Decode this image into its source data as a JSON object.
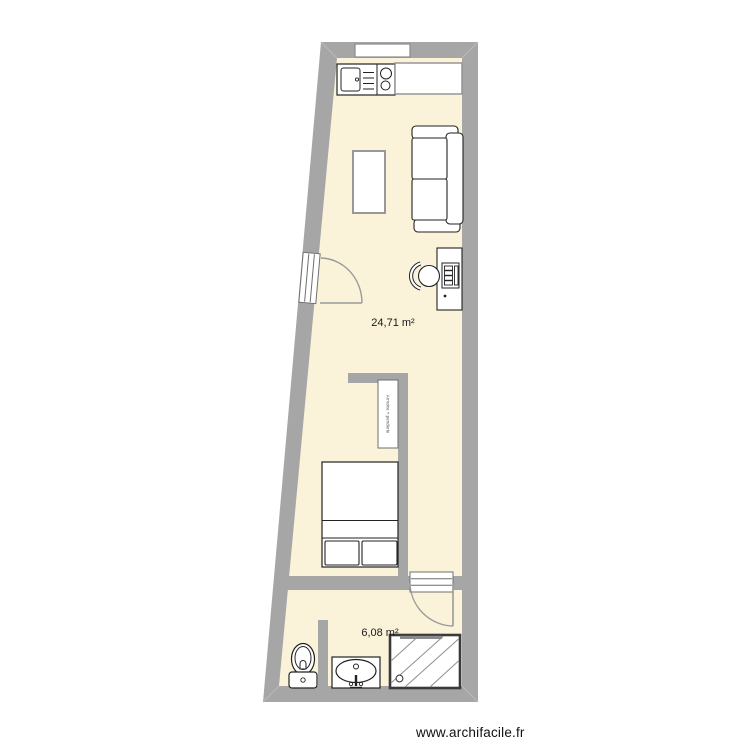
{
  "page": {
    "footer_link": "www.archifacile.fr"
  },
  "plan": {
    "colors": {
      "wall": "#a6a6a6",
      "floor": "#faf3da",
      "stroke_dark": "#222222",
      "stroke_light": "#999999"
    },
    "rooms": [
      {
        "id": "living-kitchen",
        "area_label": "24,71 m²"
      },
      {
        "id": "bathroom",
        "area_label": "6,08 m²"
      }
    ],
    "furniture": {
      "wardrobe_label": "Armoire + penderie"
    }
  }
}
